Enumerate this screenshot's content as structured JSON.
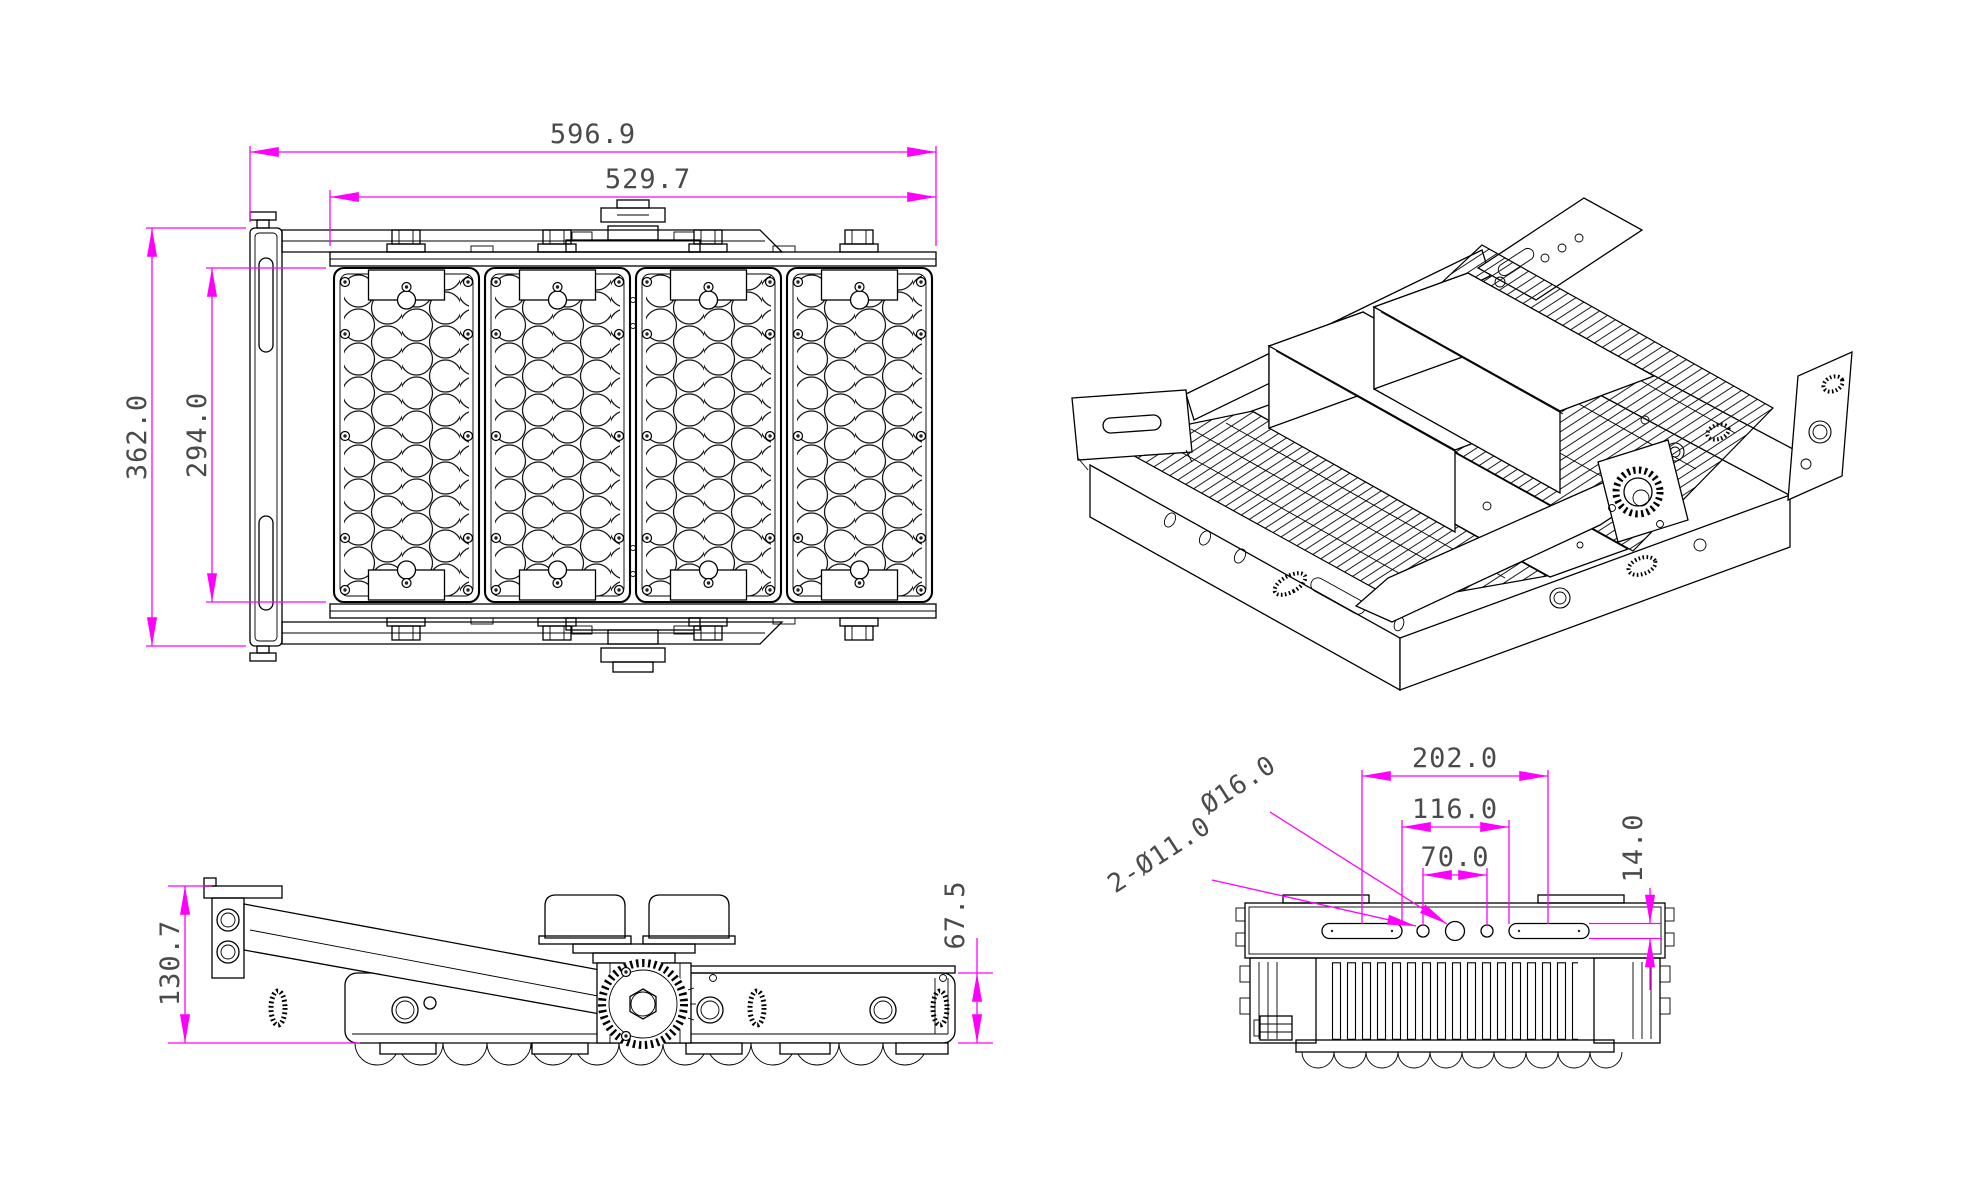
{
  "drawing": {
    "kind": "cad-technical-drawing",
    "background": "#ffffff",
    "colors": {
      "line": "#000000",
      "dimension_line": "#ff00ff",
      "dimension_text": "#4a4a4a"
    },
    "views": {
      "front": {
        "dimensions": {
          "overall_width": "596.9",
          "module_array_width": "529.7",
          "overall_height": "362.0",
          "module_height": "294.0"
        }
      },
      "isometric": {},
      "side": {
        "dimensions": {
          "overall_height": "130.7",
          "housing_height": "67.5"
        }
      },
      "end": {
        "dimensions": {
          "slot_center_spacing": "202.0",
          "slot_inner_spacing": "116.0",
          "hole_spacing": "70.0",
          "slot_width": "14.0"
        },
        "callouts": {
          "center_hole": "Ø16.0",
          "mount_holes": "2-Ø11.0"
        }
      }
    }
  }
}
